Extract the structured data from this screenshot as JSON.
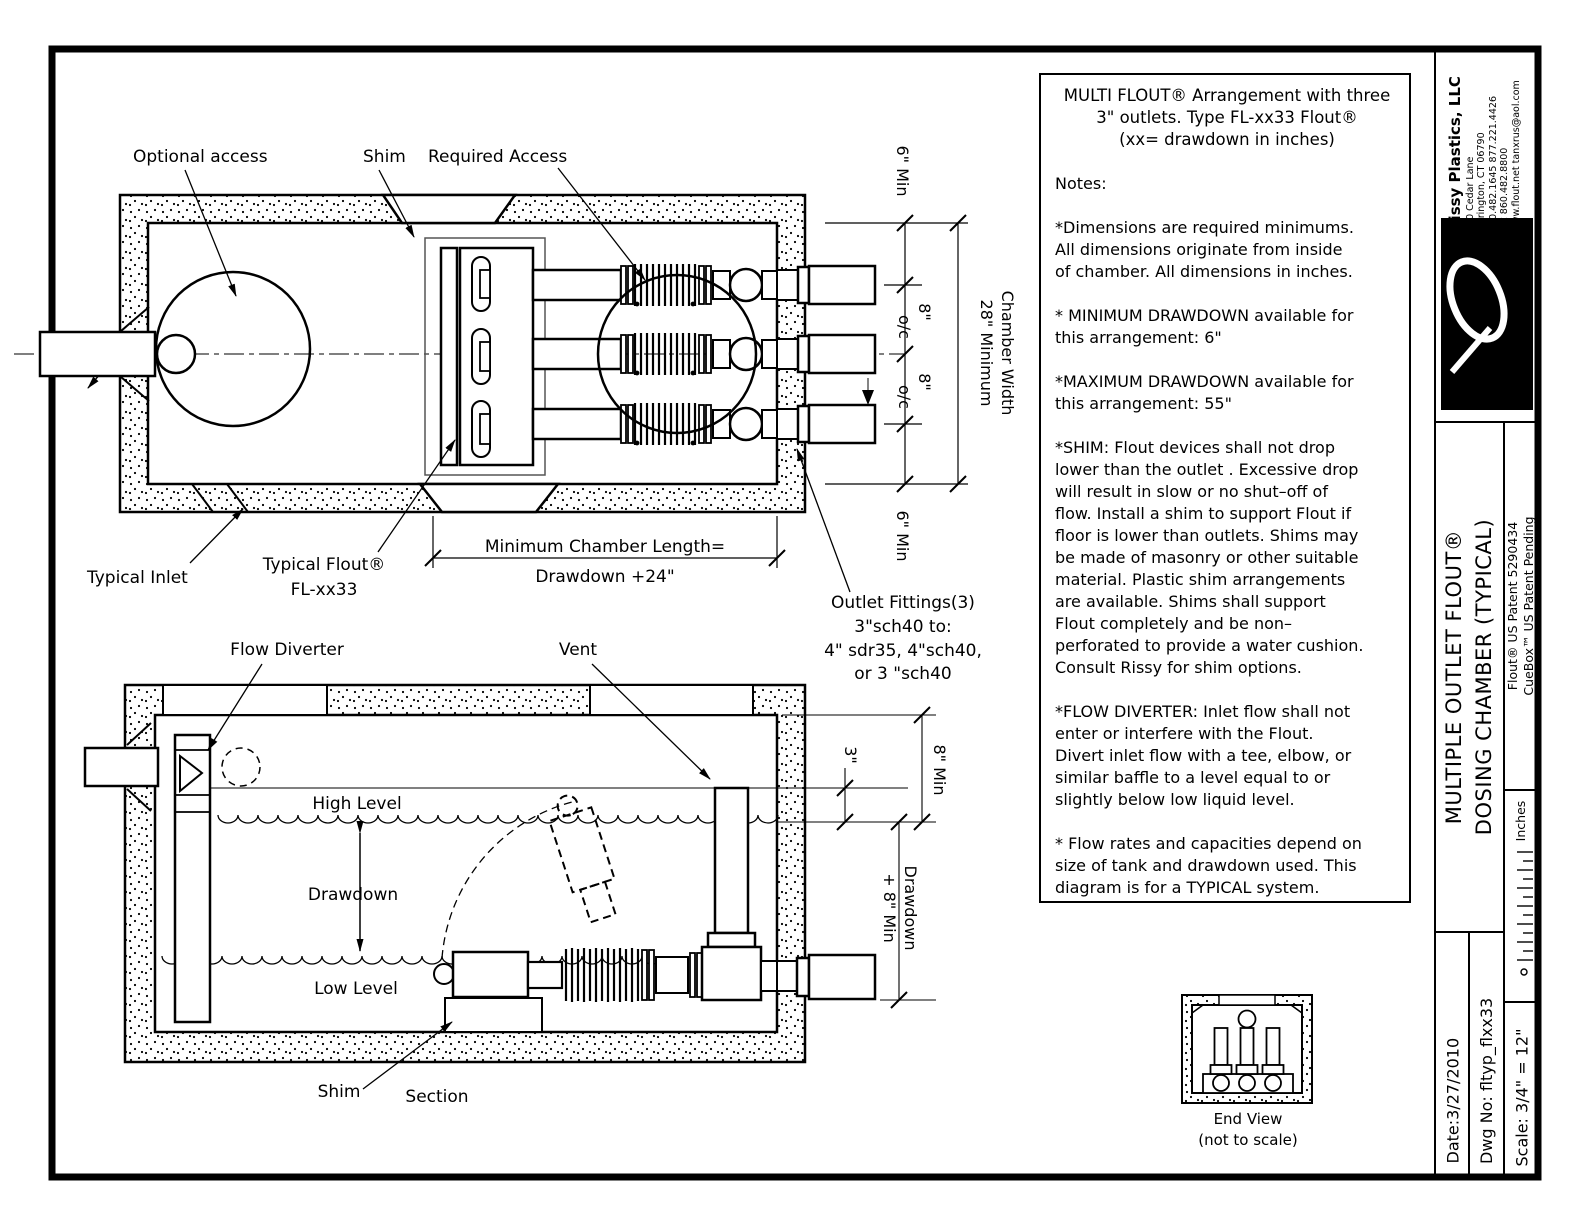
{
  "title_block": {
    "company": {
      "name": "Rissy Plastics, LLC",
      "lines": [
        "350 Cedar Lane",
        "Torrington, CT 06790",
        "860.482.1645  877.221.4426",
        "fax 860.482.8800",
        "www.flout.net  tanxrus@aol.com"
      ]
    },
    "logo_text": "RISSY PLASTICS",
    "drawing_title_line1": "MULTIPLE OUTLET FLOUT®",
    "drawing_title_line2": "DOSING CHAMBER (TYPICAL)",
    "patent_flout": "Flout® US Patent 5290434",
    "patent_cuebox": "CueBox™ US Patent Pending",
    "units": "Inches",
    "date": "Date:3/27/2010",
    "dwg_no": "Dwg No: fltyp_flxx33",
    "scale": "Scale: 3/4\" = 12\""
  },
  "notes": {
    "header": "MULTI FLOUT® Arrangement with three\n3\" outlets.  Type FL-xx33 Flout®\n(xx= drawdown in inches)",
    "label": "Notes:",
    "p1": "*Dimensions are required minimums.\nAll dimensions originate from inside\nof chamber. All dimensions in inches.",
    "p2": "* MINIMUM DRAWDOWN  available for\nthis arrangement: 6\"",
    "p3": "*MAXIMUM DRAWDOWN available  for\nthis arrangement: 55\"",
    "p4": "*SHIM: Flout devices shall not drop\nlower than the outlet . Excessive drop\nwill result in slow or no shut–off of\nflow. Install a shim to support Flout if\nfloor is lower than outlets. Shims may\nbe made of masonry or other suitable\nmaterial. Plastic shim arrangements\nare available. Shims shall support\nFlout completely and be non–\nperforated to provide a water cushion.\nConsult Rissy for shim  options.",
    "p5": "*FLOW DIVERTER: Inlet flow shall not\nenter or interfere with the Flout.\nDivert inlet flow with a tee, elbow, or\nsimilar baffle to a level equal to or\nslightly below low liquid level.",
    "p6": "* Flow rates and capacities depend on\nsize of tank and drawdown used. This\ndiagram is for a TYPICAL system."
  },
  "plan": {
    "labels": {
      "optional_access": "Optional access",
      "shim": "Shim",
      "required_access": "Required Access",
      "typical_inlet": "Typical Inlet",
      "typical_flout1": "Typical Flout®",
      "typical_flout2": "FL-xx33",
      "outlet1": "Outlet Fittings(3)",
      "outlet2": "3\"sch40 to:",
      "outlet3": "4\" sdr35, 4\"sch40,",
      "outlet4": "or 3 \"sch40"
    },
    "dims": {
      "six_min": "6\" Min",
      "eight": "8\"",
      "oc": "o/c",
      "width1": "28\" Minimum",
      "width2": "Chamber Width",
      "length1": "Minimum Chamber Length=",
      "length2": "Drawdown +24\""
    }
  },
  "section": {
    "labels": {
      "flow_diverter": "Flow Diverter",
      "vent": "Vent",
      "high_level": "High Level",
      "drawdown": "Drawdown",
      "low_level": "Low Level",
      "shim": "Shim",
      "section": "Section"
    },
    "dims": {
      "three": "3\"",
      "eight_min": "8\" Min",
      "dd1": "Drawdown",
      "dd2": "+ 8\" Min"
    }
  },
  "end_view": {
    "title": "End View",
    "subtitle": "(not to scale)"
  }
}
